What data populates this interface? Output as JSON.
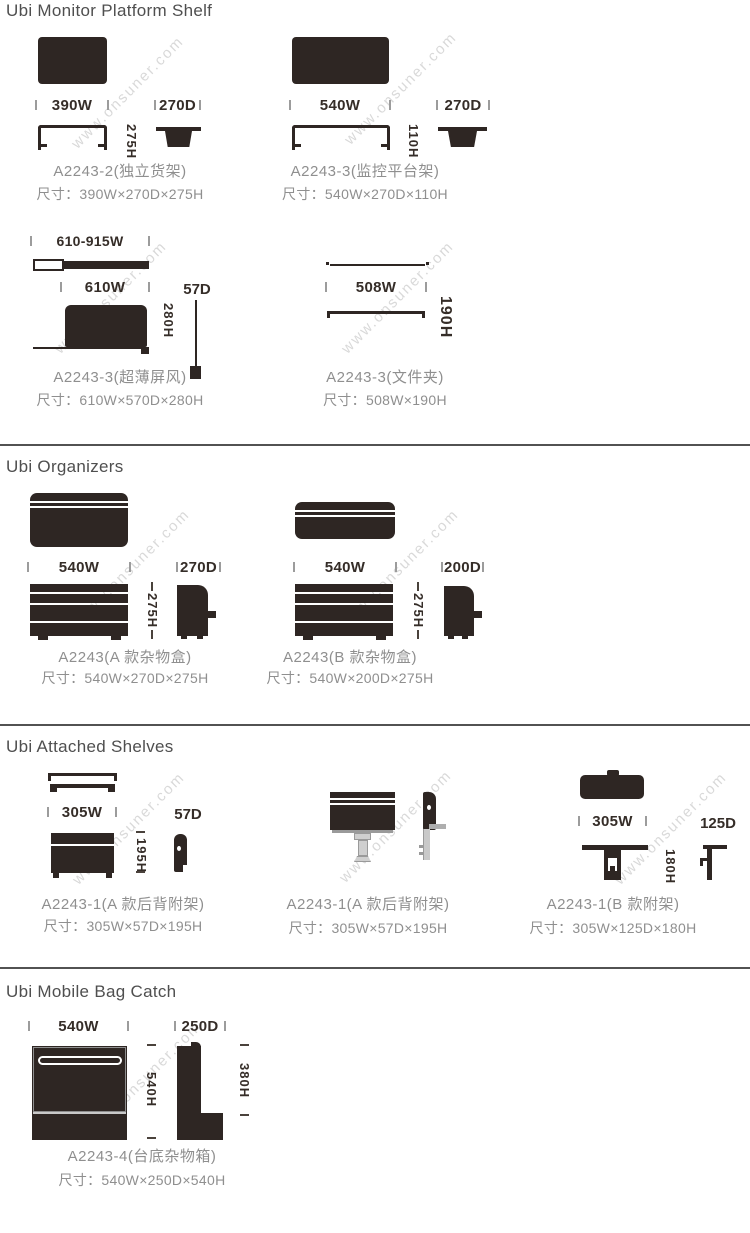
{
  "page": {
    "watermark": "www.onsuner.com"
  },
  "colors": {
    "ink": "#2e2623",
    "text_gray": "#8f8f8f",
    "label_dark": "#352d28",
    "title_gray": "#4f4f4f",
    "divider": "#525252",
    "watermark": "#d9d9d9"
  },
  "sections": [
    {
      "title": "Ubi Monitor Platform Shelf",
      "products": [
        {
          "name": "A2243-2(独立货架)",
          "size": "尺寸：390W×270D×275H",
          "w": "390W",
          "d": "270D",
          "h": "275H"
        },
        {
          "name": "A2243-3(监控平台架)",
          "size": "尺寸：540W×270D×110H",
          "w": "540W",
          "d": "270D",
          "h": "110H"
        },
        {
          "name": "A2243-3(超薄屏风)",
          "size": "尺寸：610W×570D×280H",
          "range": "610-915W",
          "w": "610W",
          "d": "57D",
          "h": "280H"
        },
        {
          "name": "A2243-3(文件夹)",
          "size": "尺寸：508W×190H",
          "w": "508W",
          "h": "190H"
        }
      ]
    },
    {
      "title": "Ubi Organizers",
      "products": [
        {
          "name": "A2243(A 款杂物盒)",
          "size": "尺寸：540W×270D×275H",
          "w": "540W",
          "d": "270D",
          "h": "275H"
        },
        {
          "name": "A2243(B 款杂物盒)",
          "size": "尺寸：540W×200D×275H",
          "w": "540W",
          "d": "200D",
          "h": "275H"
        }
      ]
    },
    {
      "title": "Ubi Attached Shelves",
      "products": [
        {
          "name": "A2243-1(A 款后背附架)",
          "size": "尺寸：305W×57D×195H",
          "w": "305W",
          "d": "57D",
          "h": "195H"
        },
        {
          "name": "A2243-1(A 款后背附架)",
          "size": "尺寸：305W×57D×195H"
        },
        {
          "name": "A2243-1(B 款附架)",
          "size": "尺寸：305W×125D×180H",
          "w": "305W",
          "d": "125D",
          "h": "180H"
        }
      ]
    },
    {
      "title": "Ubi Mobile Bag Catch",
      "products": [
        {
          "name": "A2243-4(台底杂物箱)",
          "size": "尺寸：540W×250D×540H",
          "w": "540W",
          "d": "250D",
          "h": "540H",
          "h2": "380H"
        }
      ]
    }
  ]
}
